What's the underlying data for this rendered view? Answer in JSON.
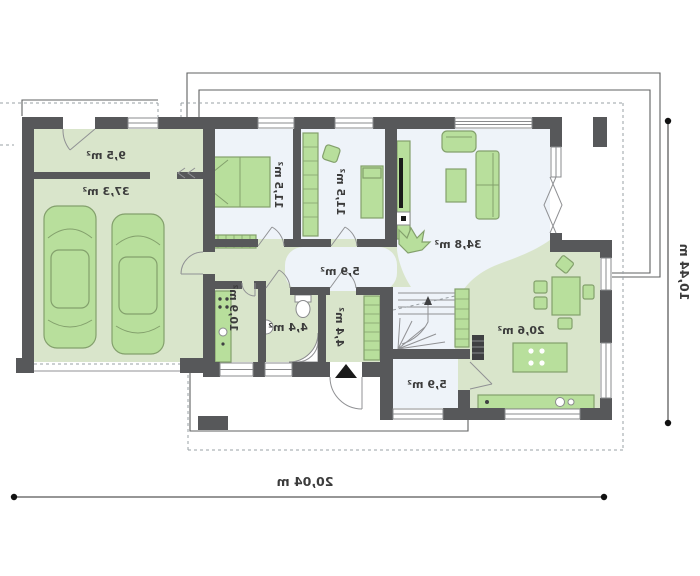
{
  "rooms": {
    "utility_store": {
      "label": "9,5 m²"
    },
    "garage": {
      "label": "37,3 m²"
    },
    "bedroom_left": {
      "label": "11,5 m²"
    },
    "bedroom_right": {
      "label": "11,5 m²"
    },
    "living_room": {
      "label": "34,8 m²"
    },
    "hall": {
      "label": "5,9 m²"
    },
    "utility_room": {
      "label": "10,9 m²"
    },
    "bathroom": {
      "label": "4,4 m²"
    },
    "vestibule": {
      "label": "4,4 m²"
    },
    "entry_room": {
      "label": "5,9 m²"
    },
    "kitchen_dining": {
      "label": "20,6 m²"
    }
  },
  "dimensions": {
    "overall_width": {
      "label": "20,04 m"
    },
    "overall_depth": {
      "label": "10,44 m"
    }
  },
  "icons": {
    "entrance_marker": "filled-triangle-up"
  },
  "colors": {
    "wall": "#57585a",
    "floor_green": "#d9e5cb",
    "floor_white": "#eef3f9",
    "furniture": "#b8df9c",
    "furniture_stroke": "#83a06c",
    "text": "#3c3c3c"
  }
}
